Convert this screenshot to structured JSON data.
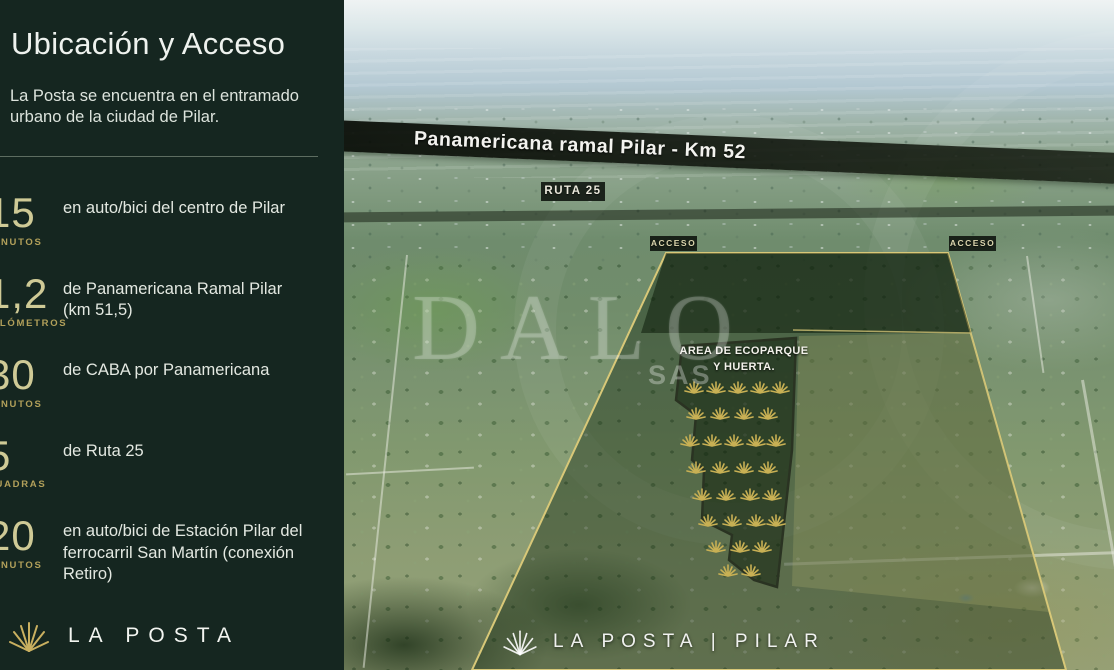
{
  "sidebar": {
    "title": "Ubicación y Acceso",
    "subtitle": "La Posta se encuentra en el entramado urbano de la ciudad de Pilar.",
    "stats": [
      {
        "value": "15",
        "unit": "MINUTOS",
        "desc": "en auto/bici del centro de Pilar"
      },
      {
        "value": "1,2",
        "unit": "KILÓMETROS",
        "desc": "de Panamericana Ramal Pilar (km 51,5)"
      },
      {
        "value": "30",
        "unit": "MINUTOS",
        "desc": "de CABA por Panamericana"
      },
      {
        "value": "5",
        "unit": "CUADRAS",
        "desc": "de Ruta 25"
      },
      {
        "value": "20",
        "unit": "MINUTOS",
        "desc": "en auto/bici de Estación Pilar del ferrocarril San Martín (conexión Retiro)"
      }
    ],
    "logo_text": "LA POSTA"
  },
  "map": {
    "highway_label": "Panamericana ramal Pilar - Km 52",
    "ruta_label": "RUTA 25",
    "access_left": "ACCESO",
    "access_right": "ACCESO",
    "ecoparque_label_line1": "AREA DE ECOPARQUE",
    "ecoparque_label_line2": "Y HUERTA.",
    "watermark_line1": "DALO",
    "watermark_line2": "SAS",
    "footer_brand": "LA POSTA | PILAR"
  },
  "colors": {
    "sidebar_bg": "#152620",
    "number_gold": "#cfca96",
    "unit_gold": "#b2a05a",
    "text_light": "#e3e8e1",
    "property_outline_gold": "#d8c878",
    "agave_gold": "#c8b054"
  }
}
